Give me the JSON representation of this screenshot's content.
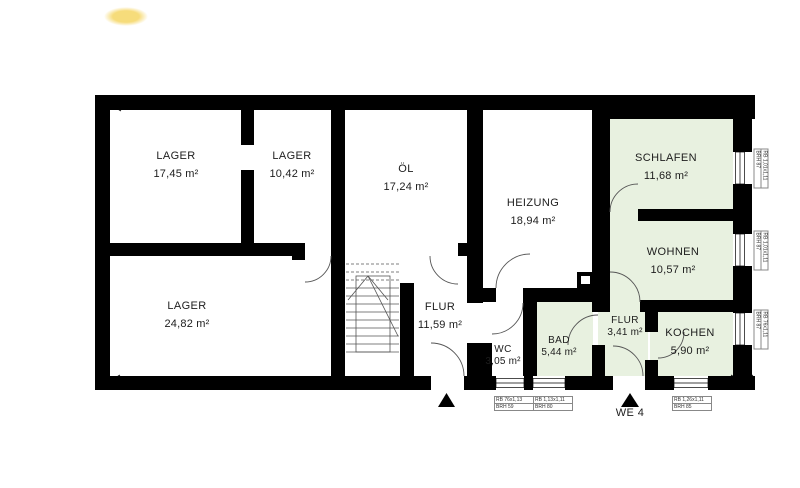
{
  "colors": {
    "wall": "#000000",
    "room_green": "#e8f1e0",
    "background": "#ffffff",
    "highlight": "#f6da74",
    "line": "#555555"
  },
  "rooms": [
    {
      "label": "LAGER",
      "area": "17,45 m²"
    },
    {
      "label": "LAGER",
      "area": "10,42 m²"
    },
    {
      "label": "ÖL",
      "area": "17,24 m²"
    },
    {
      "label": "HEIZUNG",
      "area": "18,94 m²"
    },
    {
      "label": "SCHLAFEN",
      "area": "11,68 m²"
    },
    {
      "label": "WOHNEN",
      "area": "10,57 m²"
    },
    {
      "label": "LAGER",
      "area": "24,82 m²"
    },
    {
      "label": "FLUR",
      "area": "11,59 m²"
    },
    {
      "label": "WC",
      "area": "3,05 m²"
    },
    {
      "label": "BAD",
      "area": "5,44 m²"
    },
    {
      "label": "FLUR",
      "area": "3,41 m²"
    },
    {
      "label": "KOCHEN",
      "area": "5,90 m²"
    }
  ],
  "window_notes": [
    {
      "line1": "RB 1,01x1,11",
      "line2": "BRH 87"
    },
    {
      "line1": "RB 1,01x1,11",
      "line2": "BRH 87"
    },
    {
      "line1": "RB 76x1,11",
      "line2": "BRH 87"
    },
    {
      "line1": "RB 76x1,13",
      "line2": "BRH 59"
    },
    {
      "line1": "RB 1,13x1,11",
      "line2": "BRH 80"
    },
    {
      "line1": "RB 1,26x1,11",
      "line2": "BRH 85"
    }
  ],
  "entrance": {
    "label": "WE 4"
  }
}
